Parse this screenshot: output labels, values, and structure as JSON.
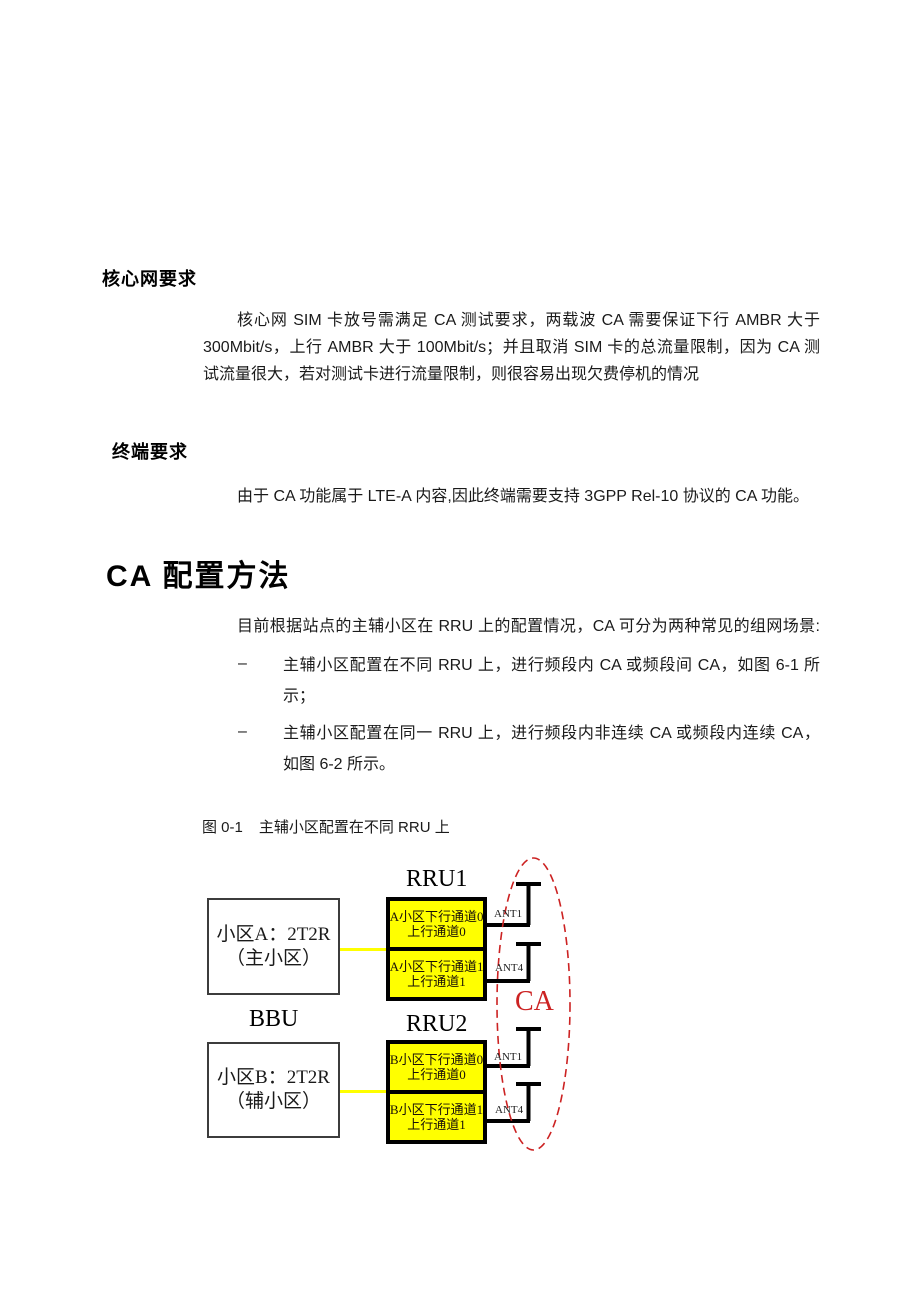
{
  "doc": {
    "heading_core": "核心网要求",
    "para_core": {
      "lines": [
        "核心网 SIM 卡放号需满足 CA 测试要求，两载波 CA 需要保证下行 AMBR 大于",
        "300Mbit/s，上行 AMBR 大于 100Mbit/s；并且取消 SIM 卡的总流量限制，因为 CA 测",
        "试流量很大，若对测试卡进行流量限制，则很容易出现欠费停机的情况"
      ]
    },
    "heading_terminal": "终端要求",
    "para_terminal": "由于 CA 功能属于 LTE-A 内容,因此终端需要支持 3GPP Rel-10 协议的 CA 功能。",
    "heading_ca": "CA 配置方法",
    "para_ca": "目前根据站点的主辅小区在 RRU 上的配置情况，CA 可分为两种常见的组网场景:",
    "bullets": [
      {
        "marker": "–",
        "lines": [
          "主辅小区配置在不同 RRU 上，进行频段内 CA 或频段间 CA，如图 6-1 所",
          "示；"
        ]
      },
      {
        "marker": "–",
        "lines": [
          "主辅小区配置在同一 RRU 上，进行频段内非连续 CA 或频段内连续 CA，",
          "如图 6-2 所示。"
        ]
      }
    ],
    "figure_caption": {
      "number": "图 0-1",
      "text": "主辅小区配置在不同 RRU 上"
    }
  },
  "diagram": {
    "bbu_label": "BBU",
    "rru1_label": "RRU1",
    "rru2_label": "RRU2",
    "cell_a": {
      "line1": "小区A：2T2R",
      "line2": "（主小区）"
    },
    "cell_b": {
      "line1": "小区B：2T2R",
      "line2": "（辅小区）"
    },
    "rru1_channels": [
      {
        "line1": "A小区下行通道0",
        "line2": "上行通道0"
      },
      {
        "line1": "A小区下行通道1",
        "line2": "上行通道1"
      }
    ],
    "rru2_channels": [
      {
        "line1": "B小区下行通道0",
        "line2": "上行通道0"
      },
      {
        "line1": "B小区下行通道1",
        "line2": "上行通道1"
      }
    ],
    "ant_labels": [
      "ANT1",
      "ANT4",
      "ANT1",
      "ANT4"
    ],
    "ca_label": "CA",
    "colors": {
      "channel_fill": "#ffff00",
      "connector_yellow": "#ffff00",
      "ca_red": "#cc2222",
      "line_black": "#000000"
    }
  }
}
